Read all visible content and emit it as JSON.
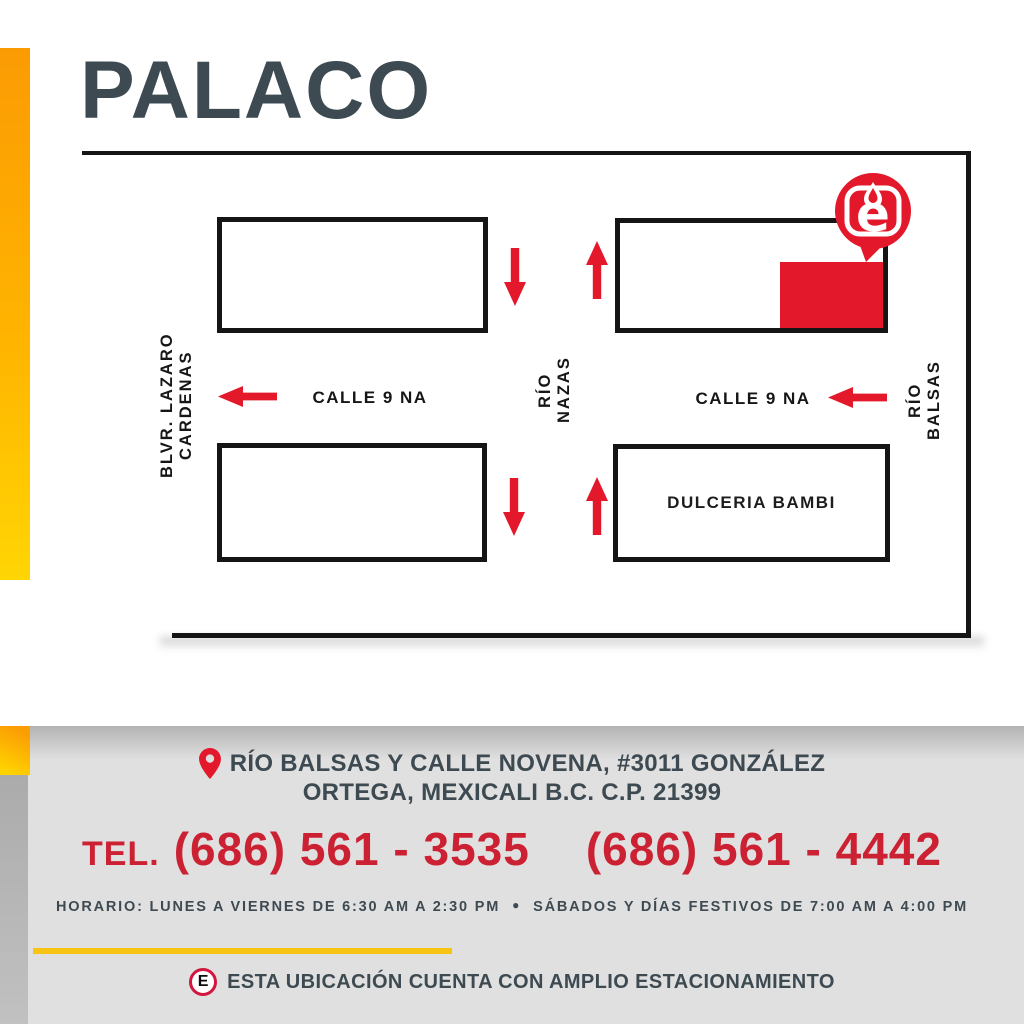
{
  "title": "PALACO",
  "colors": {
    "accent_red": "#E4182B",
    "phone_red": "#CB2133",
    "slate": "#3E4A52",
    "stripe_orange": "#FB9B04",
    "stripe_yellow": "#FFD504",
    "divider_yellow": "#F7C414",
    "panel_gray": "#E0E0E0",
    "parking_ring": "#D2163F"
  },
  "icons": {
    "logo_pin": "map-pin-with-e-logo",
    "address_pin": "location-pin",
    "parking": "parking-e-badge",
    "arrows": "red-direction-arrows"
  },
  "map": {
    "streets": {
      "left_vertical": "BLVR.  LAZARO  CARDENAS",
      "middle_vertical": "RÍO NAZAS",
      "right_vertical": "RÍO BALSAS",
      "horizontal_left": "CALLE  9 NA",
      "horizontal_right": "CALLE  9 NA"
    },
    "blocks": {
      "dulceria": "DULCERIA  BAMBI"
    },
    "pin_letter": "e"
  },
  "contact": {
    "address_line1": "RÍO BALSAS Y CALLE NOVENA, #3011 GONZÁLEZ",
    "address_line2": "ORTEGA, MEXICALI B.C. C.P. 21399",
    "tel_label": "TEL.",
    "phone1": "(686) 561 - 3535",
    "phone2": "(686) 561 - 4442",
    "horario_weekdays": "HORARIO: LUNES A VIERNES DE 6:30 AM A 2:30 PM",
    "bullet": "●",
    "horario_weekend": "SÁBADOS Y DÍAS FESTIVOS DE 7:00 AM A 4:00 PM",
    "parking_letter": "E",
    "parking_note": "ESTA UBICACIÓN CUENTA CON AMPLIO ESTACIONAMIENTO"
  }
}
